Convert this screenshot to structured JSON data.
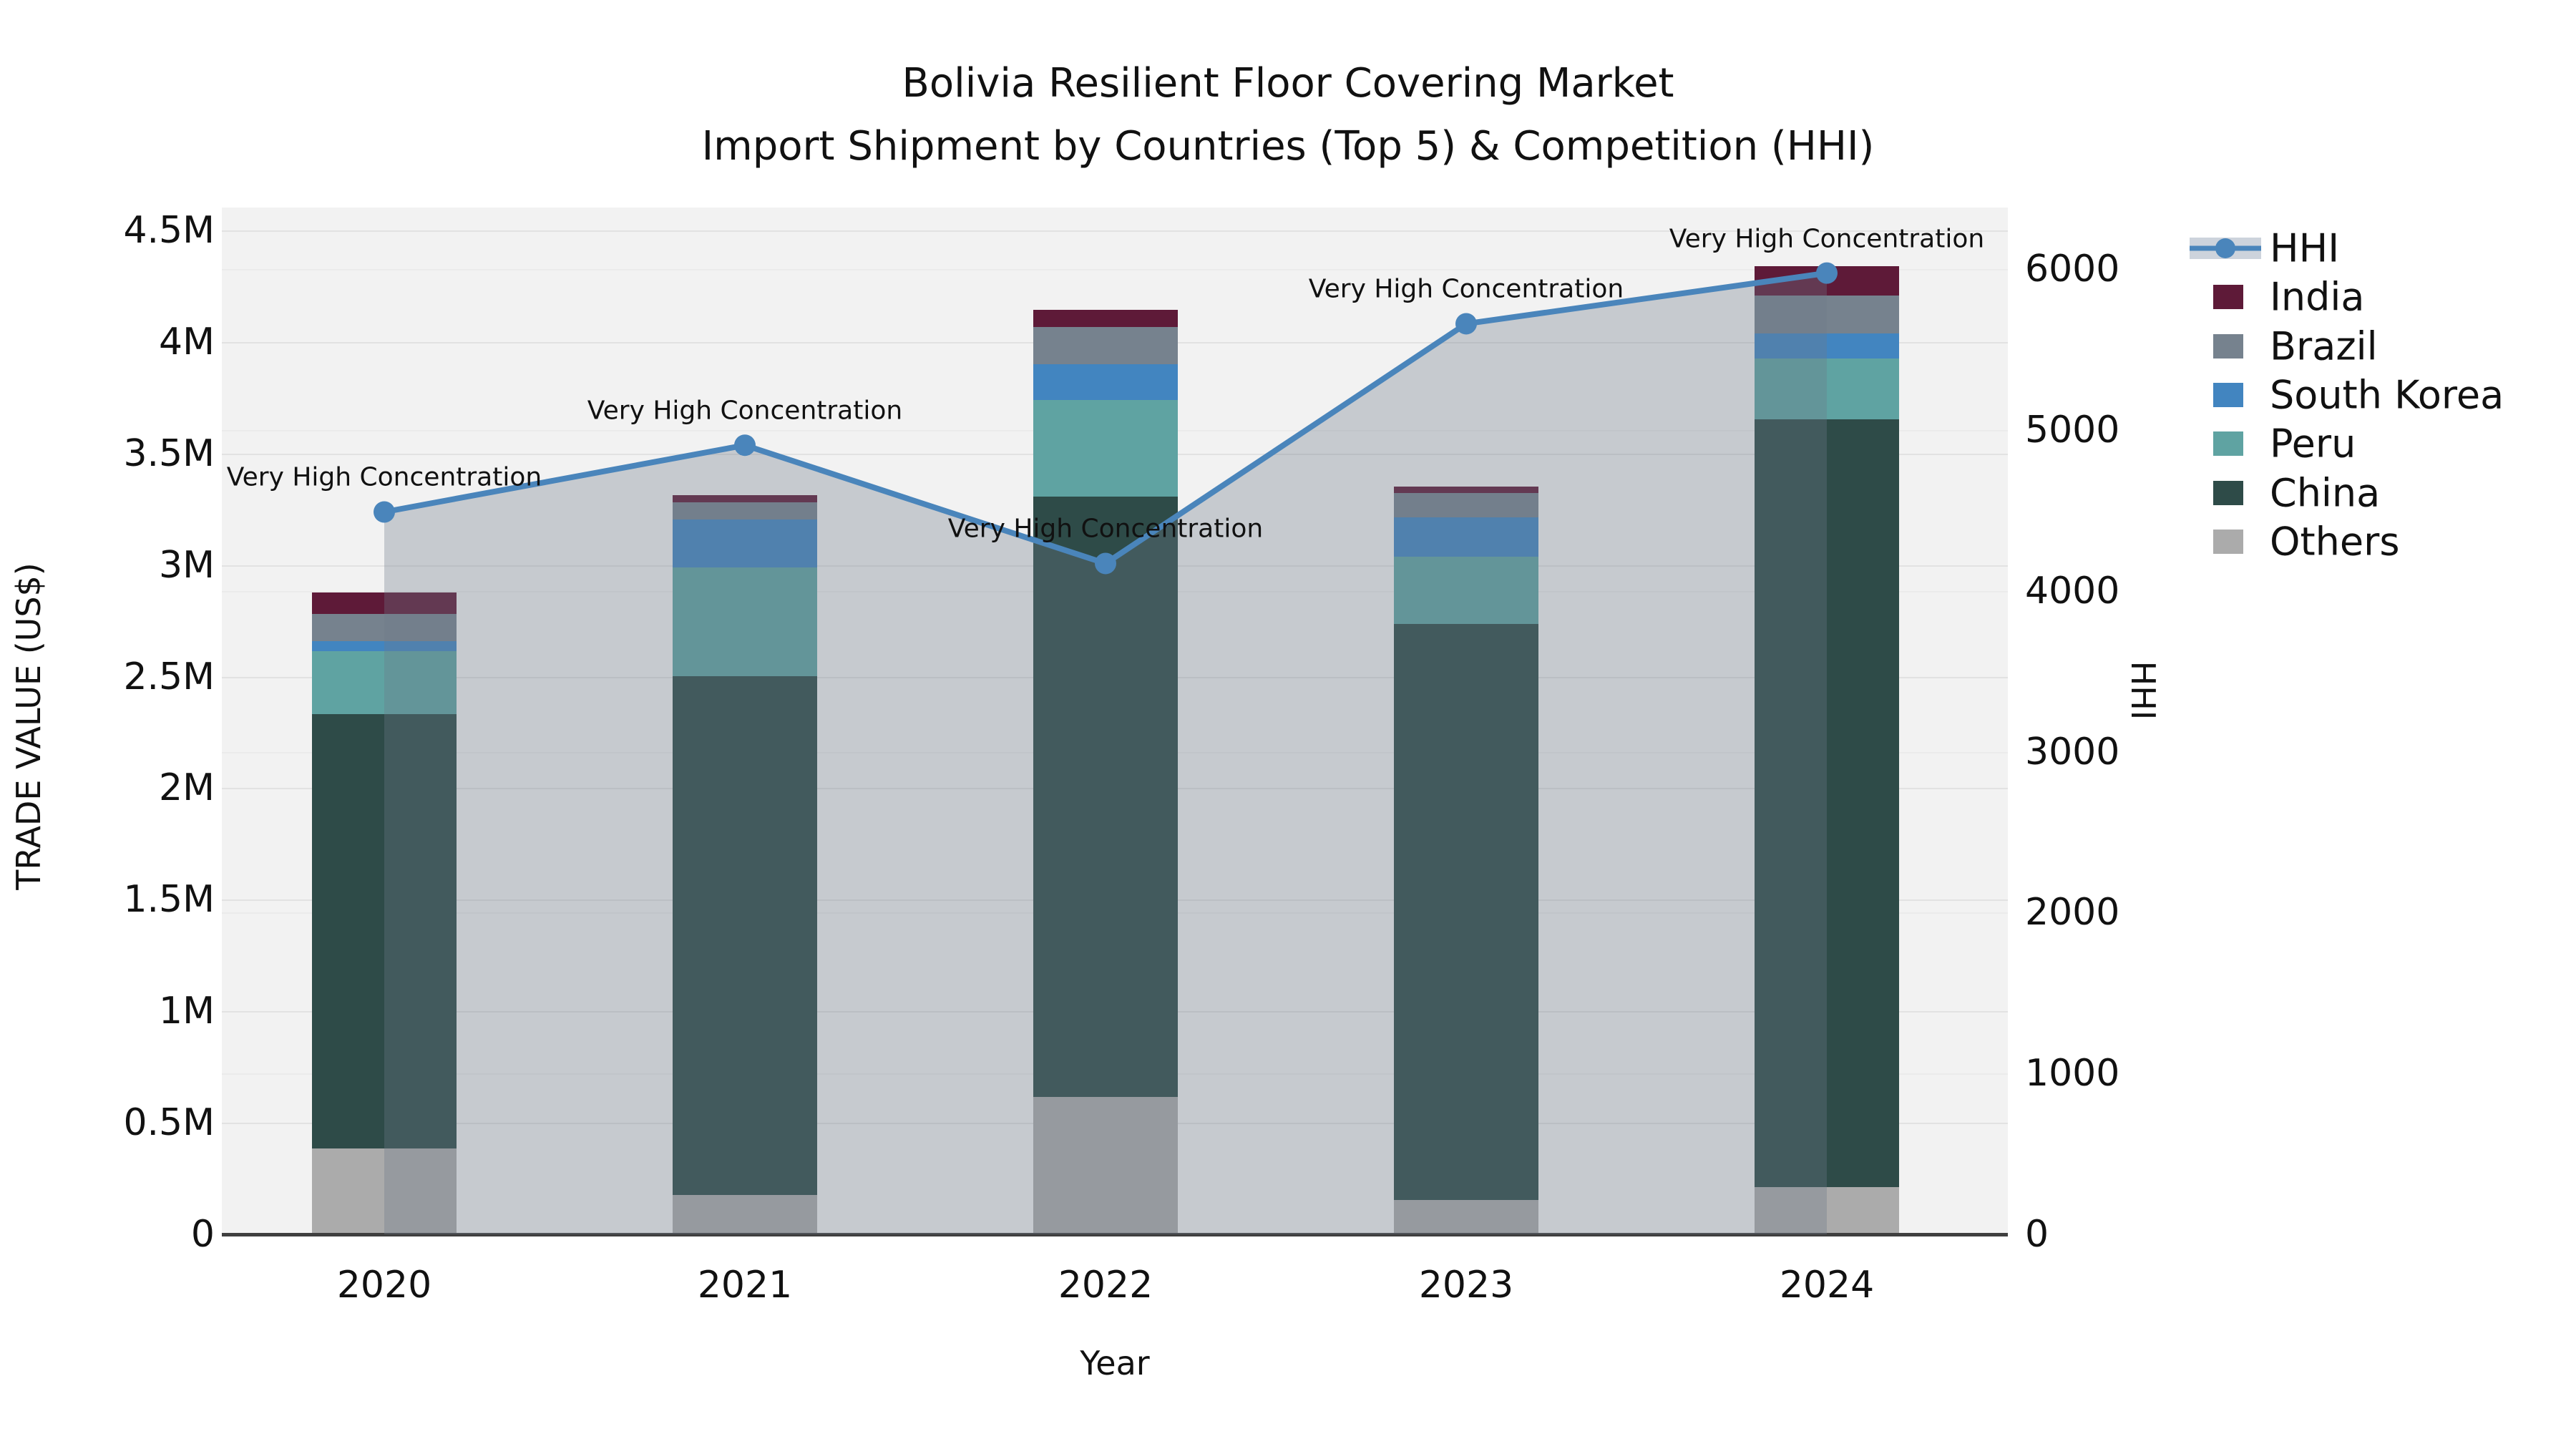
{
  "title": {
    "line1": "Bolivia Resilient Floor Covering Market",
    "line2": "Import Shipment by Countries (Top 5) & Competition (HHI)"
  },
  "axes": {
    "x": {
      "label": "Year",
      "categories": [
        "2020",
        "2021",
        "2022",
        "2023",
        "2024"
      ]
    },
    "y_left": {
      "label": "TRADE VALUE (US$)",
      "ticks": [
        "0",
        "0.5M",
        "1M",
        "1.5M",
        "2M",
        "2.5M",
        "3M",
        "3.5M",
        "4M",
        "4.5M"
      ]
    },
    "y_right": {
      "label": "HHI",
      "ticks": [
        "0",
        "1000",
        "2000",
        "3000",
        "4000",
        "5000",
        "6000"
      ]
    }
  },
  "legend": [
    {
      "label": "HHI",
      "type": "line",
      "color": "#4a85bb"
    },
    {
      "label": "India",
      "type": "swatch",
      "color": "#5e1a38"
    },
    {
      "label": "Brazil",
      "type": "swatch",
      "color": "#76828e"
    },
    {
      "label": "South Korea",
      "type": "swatch",
      "color": "#4285c0"
    },
    {
      "label": "Peru",
      "type": "swatch",
      "color": "#5fa3a2"
    },
    {
      "label": "China",
      "type": "swatch",
      "color": "#2e4b48"
    },
    {
      "label": "Others",
      "type": "swatch",
      "color": "#ababab"
    }
  ],
  "annotations": [
    "Very High Concentration",
    "Very High Concentration",
    "Very High Concentration",
    "Very High Concentration",
    "Very High Concentration"
  ],
  "chart_data": {
    "type": "combo: stacked-bar + line",
    "title": "Bolivia Resilient Floor Covering Market — Import Shipment by Countries (Top 5) & Competition (HHI)",
    "xlabel": "Year",
    "ylabel_left": "TRADE VALUE (US$)",
    "ylabel_right": "HHI",
    "categories": [
      "2020",
      "2021",
      "2022",
      "2023",
      "2024"
    ],
    "bar_value_unit": "US$",
    "stack_order_bottom_to_top": [
      "Others",
      "China",
      "Peru",
      "South Korea",
      "Brazil",
      "India"
    ],
    "series": [
      {
        "name": "India",
        "color": "#5e1a38",
        "values": [
          96000,
          32000,
          77000,
          29000,
          131000
        ]
      },
      {
        "name": "Brazil",
        "color": "#76828e",
        "values": [
          122000,
          77000,
          167000,
          109000,
          170000
        ]
      },
      {
        "name": "South Korea",
        "color": "#4285c0",
        "values": [
          45000,
          215000,
          160000,
          176000,
          112000
        ]
      },
      {
        "name": "Peru",
        "color": "#5fa3a2",
        "values": [
          282000,
          487000,
          433000,
          301000,
          273000
        ]
      },
      {
        "name": "China",
        "color": "#2e4b48",
        "values": [
          1947000,
          2325000,
          2691000,
          2582000,
          3441000
        ]
      },
      {
        "name": "Others",
        "color": "#ababab",
        "values": [
          385000,
          176000,
          616000,
          154000,
          212000
        ]
      }
    ],
    "bar_totals": [
      2877000,
      3312000,
      4144000,
      3351000,
      4339000
    ],
    "line_series": {
      "name": "HHI",
      "color": "#4a85bb",
      "fill": "rgba(108,120,138,0.33)",
      "values": [
        4490,
        4905,
        4170,
        5660,
        5975
      ]
    },
    "ylim_left": [
      0,
      4600000
    ],
    "ylim_right": [
      0,
      6400
    ],
    "grid": true,
    "legend_position": "right"
  }
}
